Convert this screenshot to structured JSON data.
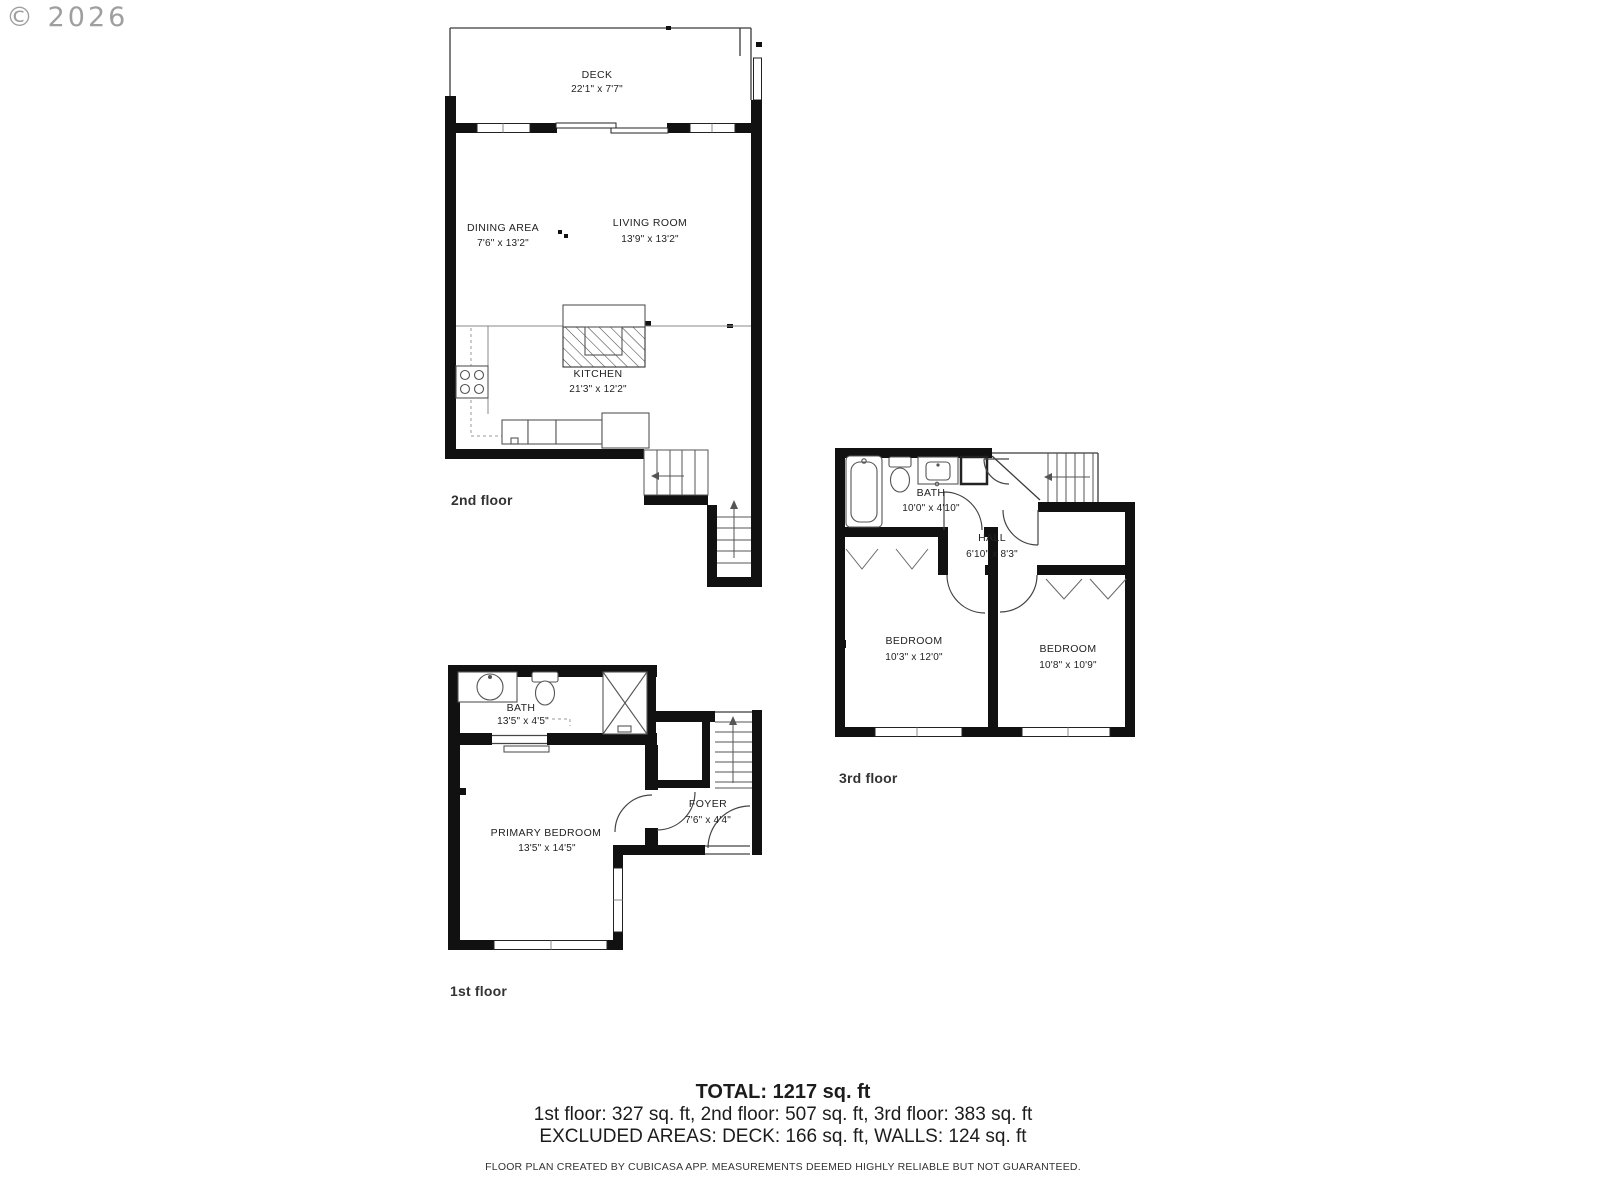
{
  "watermark": {
    "text": "© 2026"
  },
  "floors": {
    "f2": {
      "label": "2nd floor",
      "rooms": {
        "deck": {
          "name": "DECK",
          "dims": "22'1\" x 7'7\""
        },
        "dining": {
          "name": "DINING AREA",
          "dims": "7'6\" x 13'2\""
        },
        "living": {
          "name": "LIVING ROOM",
          "dims": "13'9\" x 13'2\""
        },
        "kitchen": {
          "name": "KITCHEN",
          "dims": "21'3\" x 12'2\""
        }
      }
    },
    "f3": {
      "label": "3rd floor",
      "rooms": {
        "bath": {
          "name": "BATH",
          "dims": "10'0\" x 4'10\""
        },
        "hall": {
          "name": "HALL",
          "dims": "6'10\" x 8'3\""
        },
        "bed1": {
          "name": "BEDROOM",
          "dims": "10'3\" x 12'0\""
        },
        "bed2": {
          "name": "BEDROOM",
          "dims": "10'8\" x 10'9\""
        }
      }
    },
    "f1": {
      "label": "1st floor",
      "rooms": {
        "bath": {
          "name": "BATH",
          "dims": "13'5\" x 4'5\""
        },
        "primary": {
          "name": "PRIMARY BEDROOM",
          "dims": "13'5\" x 14'5\""
        },
        "foyer": {
          "name": "FOYER",
          "dims": "7'6\" x 4'4\""
        }
      }
    }
  },
  "summary": {
    "total": "TOTAL: 1217 sq. ft",
    "floors_line": "1st floor: 327 sq. ft, 2nd floor: 507 sq. ft, 3rd floor: 383 sq. ft",
    "excluded_line": "EXCLUDED AREAS: DECK: 166 sq. ft, WALLS: 124 sq. ft",
    "disclaimer": "FLOOR PLAN CREATED BY CUBICASA APP. MEASUREMENTS DEEMED HIGHLY RELIABLE BUT NOT GUARANTEED."
  },
  "colors": {
    "wall": "#111111",
    "line": "#3a3a3a",
    "text": "#222222",
    "watermark": "#8f8f8f"
  }
}
